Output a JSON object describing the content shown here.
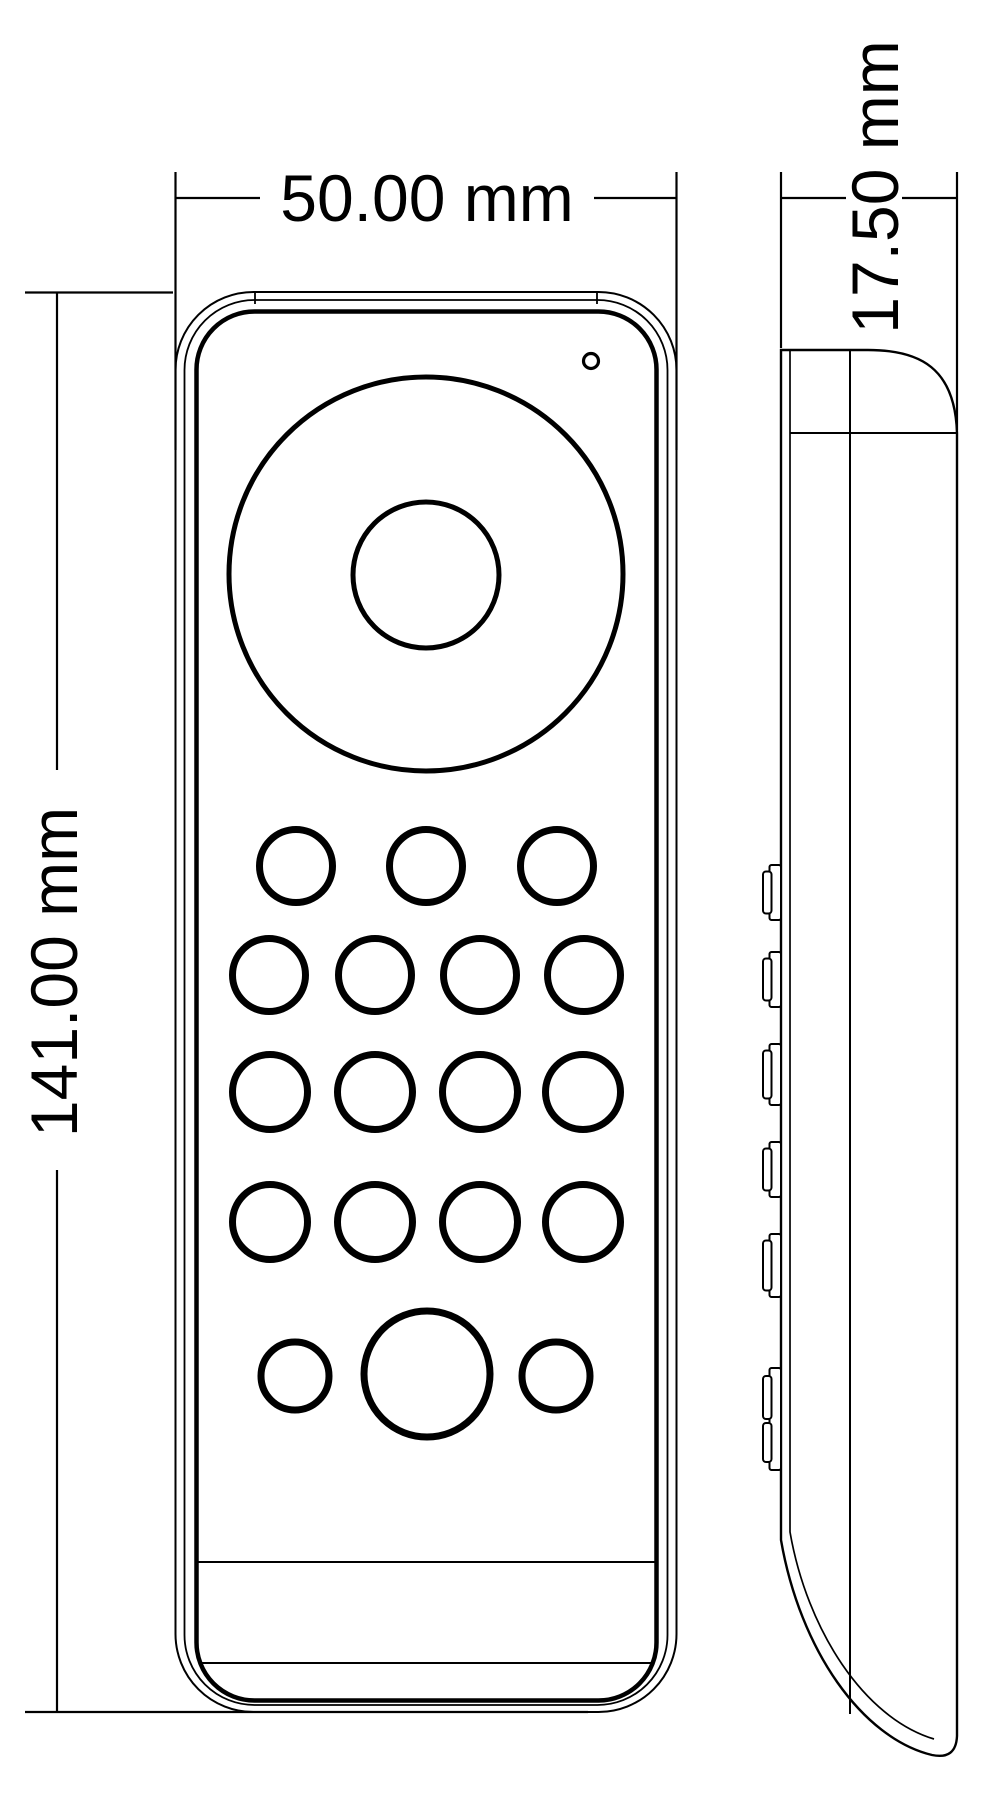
{
  "page": {
    "background": "#ffffff",
    "line_color": "#000000"
  },
  "drawing": {
    "type": "technical-dimension-drawing",
    "subject": "handheld-remote-control",
    "views": {
      "front": {
        "name": "front-view",
        "features": {
          "dial": "rotary-wheel-with-center-button",
          "led": "indicator-hole-top-right",
          "button_rows": [
            3,
            4,
            4,
            4,
            3
          ],
          "bottom_row_style": "small-large-small",
          "battery_cover_lines": 2
        }
      },
      "side": {
        "name": "side-profile-view",
        "side_button_bumps": 6
      }
    },
    "dimensions": {
      "width": {
        "label": "50.00 mm",
        "value_mm": 50.0
      },
      "height": {
        "label": "141.00 mm",
        "value_mm": 141.0
      },
      "depth": {
        "label": "17.50 mm",
        "value_mm": 17.5
      }
    }
  }
}
